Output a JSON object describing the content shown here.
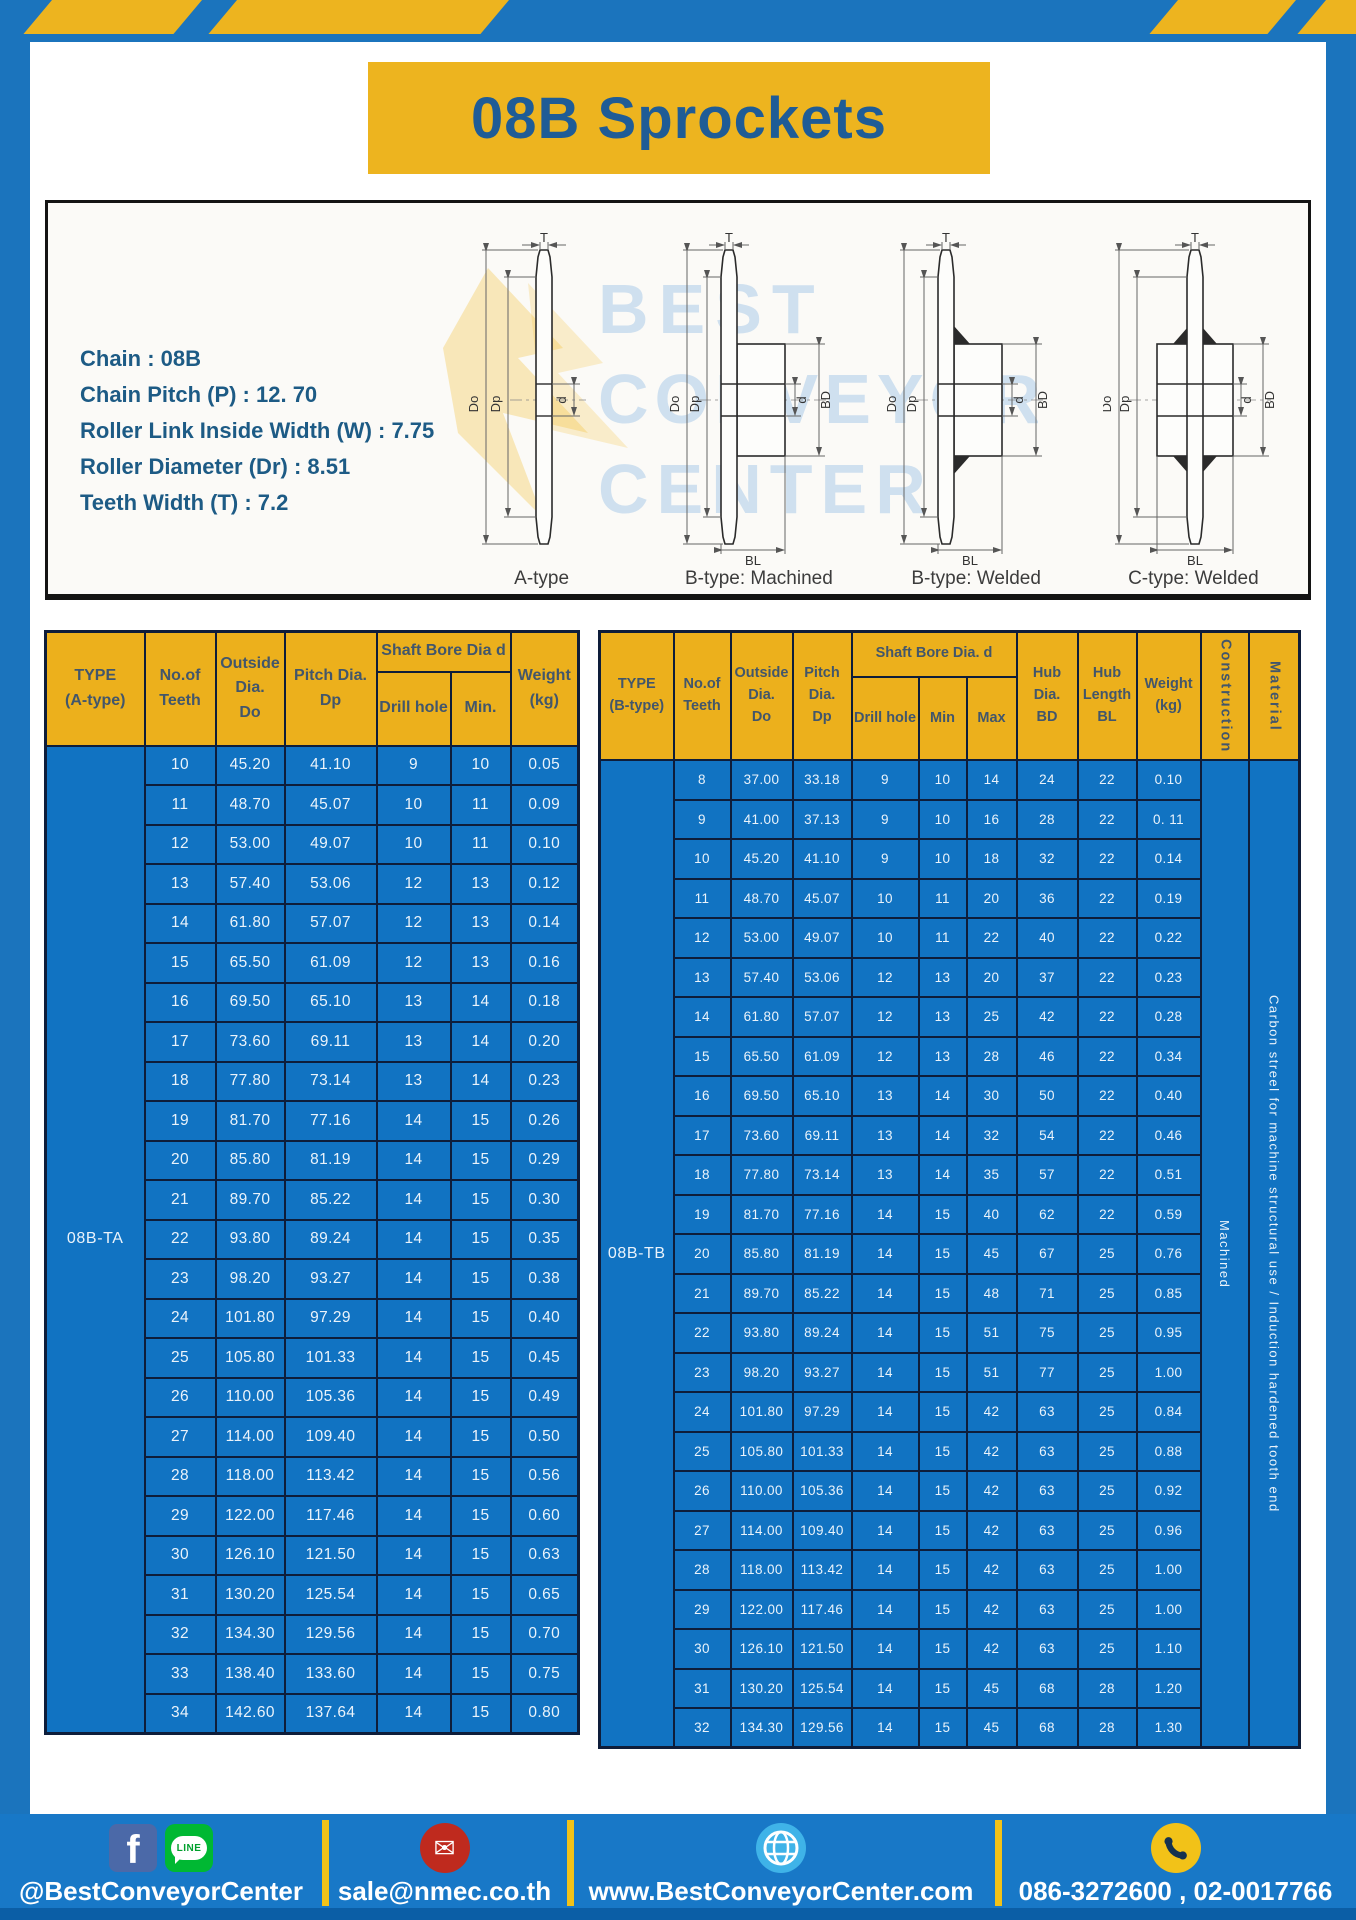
{
  "header": {
    "title": "08B Sprockets"
  },
  "specs": [
    "Chain : 08B",
    "Chain Pitch (P) : 12. 70",
    "Roller Link Inside Width (W) : 7.75",
    "Roller Diameter (Dr) : 8.51",
    "Teeth Width (T) : 7.2"
  ],
  "diagram": {
    "captions": [
      "A-type",
      "B-type: Machined",
      "B-type: Welded",
      "C-type: Welded"
    ],
    "dims": {
      "t": "T",
      "outside": "Do",
      "pitch": "Dp",
      "bore": "d",
      "hub_dia": "BD",
      "hub_len": "BL"
    },
    "watermark_lines": [
      "BEST",
      "CONVEYOR",
      "CENTER"
    ]
  },
  "table_a": {
    "h_type": "TYPE\n(A-type)",
    "h_teeth": "No.of\nTeeth",
    "h_outside": "Outside\nDia.\nDo",
    "h_pitch": "Pitch Dia.\nDp",
    "h_bore": "Shaft Bore Dia d",
    "h_drill": "Drill hole",
    "h_min": "Min.",
    "h_weight": "Weight\n(kg)",
    "type_label": "08B-TA",
    "rows": [
      [
        "10",
        "45.20",
        "41.10",
        "9",
        "10",
        "0.05"
      ],
      [
        "11",
        "48.70",
        "45.07",
        "10",
        "11",
        "0.09"
      ],
      [
        "12",
        "53.00",
        "49.07",
        "10",
        "11",
        "0.10"
      ],
      [
        "13",
        "57.40",
        "53.06",
        "12",
        "13",
        "0.12"
      ],
      [
        "14",
        "61.80",
        "57.07",
        "12",
        "13",
        "0.14"
      ],
      [
        "15",
        "65.50",
        "61.09",
        "12",
        "13",
        "0.16"
      ],
      [
        "16",
        "69.50",
        "65.10",
        "13",
        "14",
        "0.18"
      ],
      [
        "17",
        "73.60",
        "69.11",
        "13",
        "14",
        "0.20"
      ],
      [
        "18",
        "77.80",
        "73.14",
        "13",
        "14",
        "0.23"
      ],
      [
        "19",
        "81.70",
        "77.16",
        "14",
        "15",
        "0.26"
      ],
      [
        "20",
        "85.80",
        "81.19",
        "14",
        "15",
        "0.29"
      ],
      [
        "21",
        "89.70",
        "85.22",
        "14",
        "15",
        "0.30"
      ],
      [
        "22",
        "93.80",
        "89.24",
        "14",
        "15",
        "0.35"
      ],
      [
        "23",
        "98.20",
        "93.27",
        "14",
        "15",
        "0.38"
      ],
      [
        "24",
        "101.80",
        "97.29",
        "14",
        "15",
        "0.40"
      ],
      [
        "25",
        "105.80",
        "101.33",
        "14",
        "15",
        "0.45"
      ],
      [
        "26",
        "110.00",
        "105.36",
        "14",
        "15",
        "0.49"
      ],
      [
        "27",
        "114.00",
        "109.40",
        "14",
        "15",
        "0.50"
      ],
      [
        "28",
        "118.00",
        "113.42",
        "14",
        "15",
        "0.56"
      ],
      [
        "29",
        "122.00",
        "117.46",
        "14",
        "15",
        "0.60"
      ],
      [
        "30",
        "126.10",
        "121.50",
        "14",
        "15",
        "0.63"
      ],
      [
        "31",
        "130.20",
        "125.54",
        "14",
        "15",
        "0.65"
      ],
      [
        "32",
        "134.30",
        "129.56",
        "14",
        "15",
        "0.70"
      ],
      [
        "33",
        "138.40",
        "133.60",
        "14",
        "15",
        "0.75"
      ],
      [
        "34",
        "142.60",
        "137.64",
        "14",
        "15",
        "0.80"
      ]
    ]
  },
  "table_b": {
    "h_type": "TYPE\n(B-type)",
    "h_teeth": "No.of\nTeeth",
    "h_outside": "Outside\nDia.\nDo",
    "h_pitch": "Pitch\nDia.\nDp",
    "h_bore": "Shaft Bore Dia. d",
    "h_drill": "Drill hole",
    "h_min": "Min",
    "h_max": "Max",
    "h_hub_dia": "Hub\nDia.\nBD",
    "h_hub_len": "Hub\nLength\nBL",
    "h_weight": "Weight\n(kg)",
    "h_construction": "Construction",
    "h_material": "Material",
    "type_label": "08B-TB",
    "construction_value": "Machined",
    "material_value": "Carbon streel for machine structural use / Induction hardened tooth end",
    "rows": [
      [
        "8",
        "37.00",
        "33.18",
        "9",
        "10",
        "14",
        "24",
        "22",
        "0.10"
      ],
      [
        "9",
        "41.00",
        "37.13",
        "9",
        "10",
        "16",
        "28",
        "22",
        "0. 11"
      ],
      [
        "10",
        "45.20",
        "41.10",
        "9",
        "10",
        "18",
        "32",
        "22",
        "0.14"
      ],
      [
        "11",
        "48.70",
        "45.07",
        "10",
        "11",
        "20",
        "36",
        "22",
        "0.19"
      ],
      [
        "12",
        "53.00",
        "49.07",
        "10",
        "11",
        "22",
        "40",
        "22",
        "0.22"
      ],
      [
        "13",
        "57.40",
        "53.06",
        "12",
        "13",
        "20",
        "37",
        "22",
        "0.23"
      ],
      [
        "14",
        "61.80",
        "57.07",
        "12",
        "13",
        "25",
        "42",
        "22",
        "0.28"
      ],
      [
        "15",
        "65.50",
        "61.09",
        "12",
        "13",
        "28",
        "46",
        "22",
        "0.34"
      ],
      [
        "16",
        "69.50",
        "65.10",
        "13",
        "14",
        "30",
        "50",
        "22",
        "0.40"
      ],
      [
        "17",
        "73.60",
        "69.11",
        "13",
        "14",
        "32",
        "54",
        "22",
        "0.46"
      ],
      [
        "18",
        "77.80",
        "73.14",
        "13",
        "14",
        "35",
        "57",
        "22",
        "0.51"
      ],
      [
        "19",
        "81.70",
        "77.16",
        "14",
        "15",
        "40",
        "62",
        "22",
        "0.59"
      ],
      [
        "20",
        "85.80",
        "81.19",
        "14",
        "15",
        "45",
        "67",
        "25",
        "0.76"
      ],
      [
        "21",
        "89.70",
        "85.22",
        "14",
        "15",
        "48",
        "71",
        "25",
        "0.85"
      ],
      [
        "22",
        "93.80",
        "89.24",
        "14",
        "15",
        "51",
        "75",
        "25",
        "0.95"
      ],
      [
        "23",
        "98.20",
        "93.27",
        "14",
        "15",
        "51",
        "77",
        "25",
        "1.00"
      ],
      [
        "24",
        "101.80",
        "97.29",
        "14",
        "15",
        "42",
        "63",
        "25",
        "0.84"
      ],
      [
        "25",
        "105.80",
        "101.33",
        "14",
        "15",
        "42",
        "63",
        "25",
        "0.88"
      ],
      [
        "26",
        "110.00",
        "105.36",
        "14",
        "15",
        "42",
        "63",
        "25",
        "0.92"
      ],
      [
        "27",
        "114.00",
        "109.40",
        "14",
        "15",
        "42",
        "63",
        "25",
        "0.96"
      ],
      [
        "28",
        "118.00",
        "113.42",
        "14",
        "15",
        "42",
        "63",
        "25",
        "1.00"
      ],
      [
        "29",
        "122.00",
        "117.46",
        "14",
        "15",
        "42",
        "63",
        "25",
        "1.00"
      ],
      [
        "30",
        "126.10",
        "121.50",
        "14",
        "15",
        "42",
        "63",
        "25",
        "1.10"
      ],
      [
        "31",
        "130.20",
        "125.54",
        "14",
        "15",
        "45",
        "68",
        "28",
        "1.20"
      ],
      [
        "32",
        "134.30",
        "129.56",
        "14",
        "15",
        "45",
        "68",
        "28",
        "1.30"
      ]
    ]
  },
  "footer": {
    "social_handle": "@BestConveyorCenter",
    "email": "sale@nmec.co.th",
    "website": "www.BestConveyorCenter.com",
    "phone": "086-3272600 , 02-0017766",
    "facebook_letter": "f",
    "line_label": "LINE",
    "icons": [
      "facebook-icon",
      "line-icon",
      "mail-icon",
      "globe-icon",
      "phone-icon"
    ]
  },
  "colors": {
    "frame_blue": "#1b74bd",
    "accent_yellow": "#edb41f",
    "table_header_yellow": "#ecb01c",
    "table_cell_blue": "#1173c2",
    "table_border": "#0e1d3a",
    "title_text": "#1f5c96",
    "footer_dark_strip": "#0b5ea6"
  }
}
